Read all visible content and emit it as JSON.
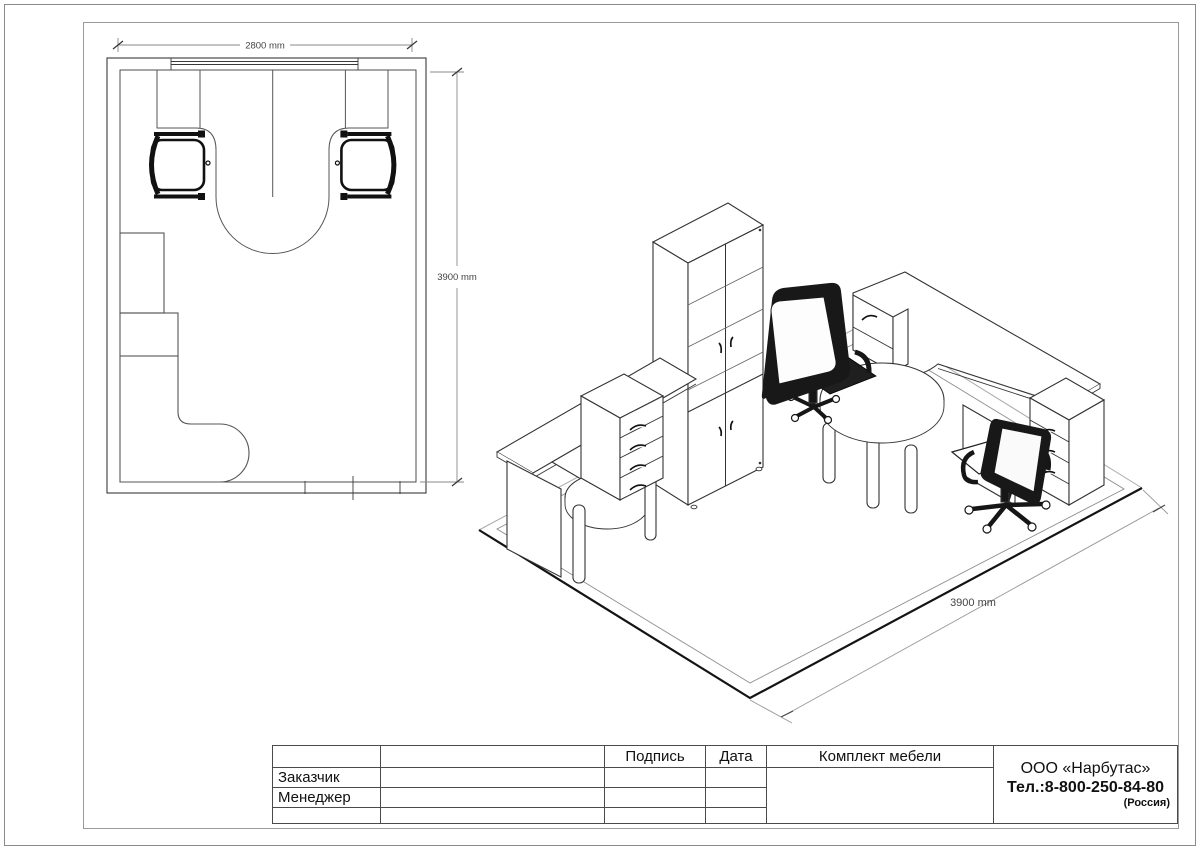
{
  "floor_plan": {
    "width_label": "2800 mm",
    "height_label": "3900 mm"
  },
  "iso_view": {
    "depth_label": "3900 mm"
  },
  "title_block": {
    "signature_header": "Подпись",
    "date_header": "Дата",
    "customer_label": "Заказчик",
    "manager_label": "Менеджер",
    "set_title": "Комплект мебели",
    "company": {
      "name": "ООО «Нарбутас»",
      "phone": "Тел.:8-800-250-84-80",
      "country": "(Россия)"
    }
  },
  "colors": {
    "line": "#3a3a3a",
    "furniture_line": "#555555",
    "dim_line": "#888888",
    "chair_black": "#161616",
    "frame": "#9a9a9a"
  }
}
